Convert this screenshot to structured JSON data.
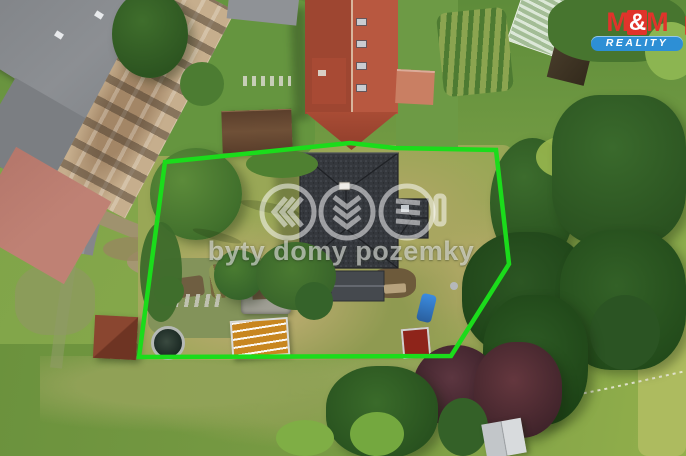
{
  "watermark": {
    "text": "byty domy pozemky"
  },
  "logo": {
    "m_left": "M",
    "ampersand": "&",
    "m_right": "M",
    "subtitle": "REALITY"
  },
  "annotation": {
    "polygon_points": "165,162 350,143 395,148 496,150 509,264 451,356 139,357"
  },
  "colors": {
    "boundary-green": "#1bdc1b",
    "logo-red": "#e0332b",
    "logo-blue": "#2d8fd5",
    "roof-dark": "#35383d",
    "roof-red-left": "#9e4631",
    "roof-red-right": "#b85840",
    "roof-gray": "#84878b",
    "roof-salmon": "#bf8174",
    "facade-tan": "#c6ae8d",
    "grass-base": "#7da348",
    "plot-lawn": "#9aa756",
    "meadow-green": "#6b923d",
    "tree-dark": "#2c5623",
    "tree-maroon": "#4e2b34"
  }
}
